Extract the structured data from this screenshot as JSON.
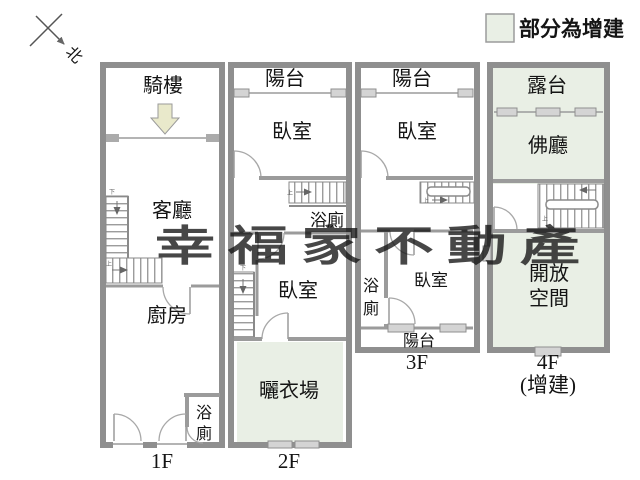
{
  "legend": {
    "label": "部分為增建",
    "swatch_color": "#e9efe5"
  },
  "compass": {
    "north_label": "北"
  },
  "watermark": {
    "text": "幸福家不動產",
    "color": "#b2a45f"
  },
  "stairs": {
    "up_label": "上",
    "down_label": "下"
  },
  "colors": {
    "wall": "#8f8f8f",
    "partition": "#9b9b9b",
    "addition_fill": "#e9efe5",
    "entrance_arrow_fill": "#e9e9cb"
  },
  "floors": [
    {
      "label": "1F",
      "rooms": {
        "arcade": "騎樓",
        "living_room": "客廳",
        "kitchen": "廚房",
        "bathroom_line1": "浴",
        "bathroom_line2": "廁"
      }
    },
    {
      "label": "2F",
      "rooms": {
        "balcony": "陽台",
        "bedroom_front": "臥室",
        "bathroom": "浴廁",
        "bedroom_rear": "臥室",
        "laundry_area": "曬衣場"
      }
    },
    {
      "label": "3F",
      "rooms": {
        "balcony_front": "陽台",
        "bedroom_front": "臥室",
        "bathroom_line1": "浴",
        "bathroom_line2": "廁",
        "bedroom_rear": "臥室",
        "balcony_rear": "陽台"
      }
    },
    {
      "label": "4F",
      "sublabel": "(增建)",
      "rooms": {
        "terrace": "露台",
        "buddha_hall": "佛廳",
        "open_space_line1": "開放",
        "open_space_line2": "空間"
      }
    }
  ]
}
